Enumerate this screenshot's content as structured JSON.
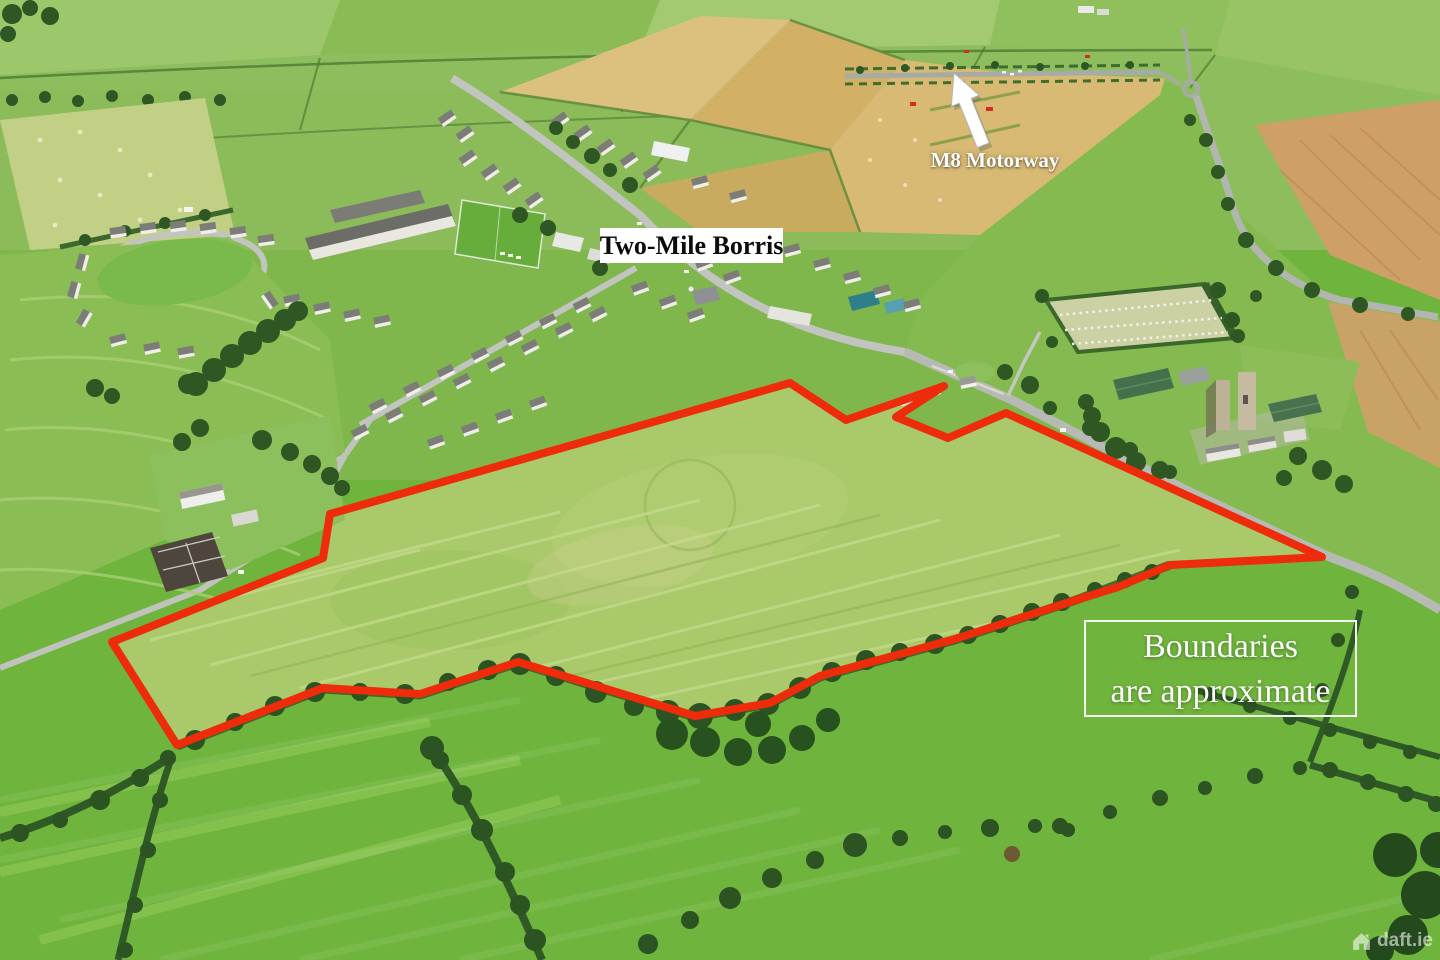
{
  "page": {
    "title": "Aerial photograph of lands at Two-Mile Borris"
  },
  "overlays": {
    "town_label": "Two-Mile Borris",
    "motorway_label": "M8 Motorway",
    "disclaimer": {
      "line1": "Boundaries",
      "line2": "are approximate"
    },
    "watermark": "daft.ie"
  },
  "boundary": {
    "color": "#ee2b0a",
    "stroke_width": 8,
    "points": "790,383 846,420 944,386 896,417 948,438 1006,413 1322,557 1170,565 1118,587 1076,600 955,639 820,676 770,703 695,716 518,662 420,694 323,688 177,745 112,642 323,558 330,514"
  },
  "icons": {
    "arrow": "up-left-arrow",
    "watermark_house": "house-icon"
  },
  "colors": {
    "label_background": "#ffffff",
    "label_text": "#0c0c0c",
    "overlay_text": "#ffffff",
    "grass_foreground": "#6fb43c",
    "grass_field": "#a9c96a",
    "wheat": "#d8ba74",
    "hedge": "#2e5724",
    "road": "#b9bcb6"
  }
}
